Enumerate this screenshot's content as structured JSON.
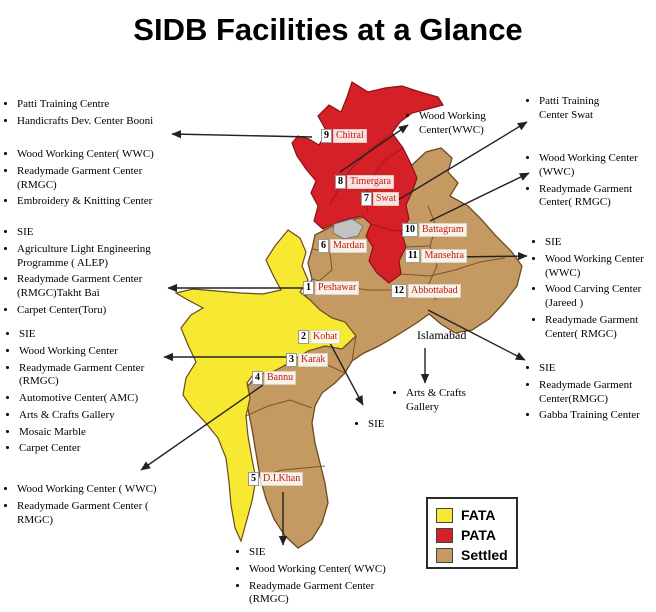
{
  "title": "SIDB Facilities at a Glance",
  "legend": {
    "items": [
      {
        "label": "FATA",
        "color": "#f7e832"
      },
      {
        "label": "PATA",
        "color": "#d62028"
      },
      {
        "label": "Settled",
        "color": "#c49a62"
      }
    ]
  },
  "map": {
    "city_label": "Islamabad",
    "region_colors": {
      "fata": "#f7e832",
      "pata": "#d62028",
      "settled": "#c49a62",
      "unlabeled": "#c2c2c2"
    },
    "districts": [
      {
        "num": "1",
        "name": "Peshawar"
      },
      {
        "num": "2",
        "name": "Kohat"
      },
      {
        "num": "3",
        "name": "Karak"
      },
      {
        "num": "4",
        "name": "Bannu"
      },
      {
        "num": "5",
        "name": "D.I.Khan"
      },
      {
        "num": "6",
        "name": "Mardan"
      },
      {
        "num": "7",
        "name": "Swat"
      },
      {
        "num": "8",
        "name": "Timergara"
      },
      {
        "num": "9",
        "name": "Chitral"
      },
      {
        "num": "10",
        "name": "Battagram"
      },
      {
        "num": "11",
        "name": "Mansehra"
      },
      {
        "num": "12",
        "name": "Abbottabad"
      }
    ]
  },
  "annotations": [
    {
      "name": "chitral-booni-list",
      "items": [
        "Patti Training Centre",
        "Handicrafts Dev. Center Booni"
      ]
    },
    {
      "name": "chitral-centers-list",
      "items": [
        "Wood Working Center( WWC)",
        "Readymade Garment Center (RMGC)",
        "Embroidery & Knitting Center"
      ]
    },
    {
      "name": "peshawar-list",
      "items": [
        "SIE",
        "Agriculture Light Engineering Programme ( ALEP)",
        "Readymade Garment Center (RMGC)Takht Bai",
        "Carpet Center(Toru)"
      ]
    },
    {
      "name": "kohat-karak-list",
      "items": [
        "SIE",
        "Wood Working Center",
        "Readymade Garment Center (RMGC)",
        "Automotive Center( AMC)",
        "Arts & Crafts Gallery",
        "Mosaic Marble",
        "Carpet Center"
      ]
    },
    {
      "name": "bannu-list",
      "items": [
        "Wood Working Center ( WWC)",
        "Readymade Garment Center ( RMGC)"
      ]
    },
    {
      "name": "timergara-list",
      "items": [
        "Wood Working Center(WWC)"
      ]
    },
    {
      "name": "swat-list",
      "items": [
        "Patti Training Center Swat"
      ]
    },
    {
      "name": "battagram-list",
      "items": [
        "Wood Working Center (WWC)",
        "Readymade Garment Center( RMGC)"
      ]
    },
    {
      "name": "mansehra-list",
      "items": [
        "SIE",
        "Wood Working Center (WWC)",
        "Wood Carving  Center (Jareed )",
        "Readymade Garment Center( RMGC)"
      ]
    },
    {
      "name": "abbottabad-list",
      "items": [
        "SIE",
        "Readymade Garment Center(RMGC)",
        "Gabba Training Center"
      ]
    },
    {
      "name": "islamabad-list",
      "items": [
        "Arts & Crafts Gallery"
      ]
    },
    {
      "name": "kohat-sie-note",
      "items": [
        "SIE"
      ]
    },
    {
      "name": "dikhan-list",
      "items": [
        "SIE",
        "Wood Working Center( WWC)",
        "Readymade Garment Center (RMGC)"
      ]
    }
  ]
}
